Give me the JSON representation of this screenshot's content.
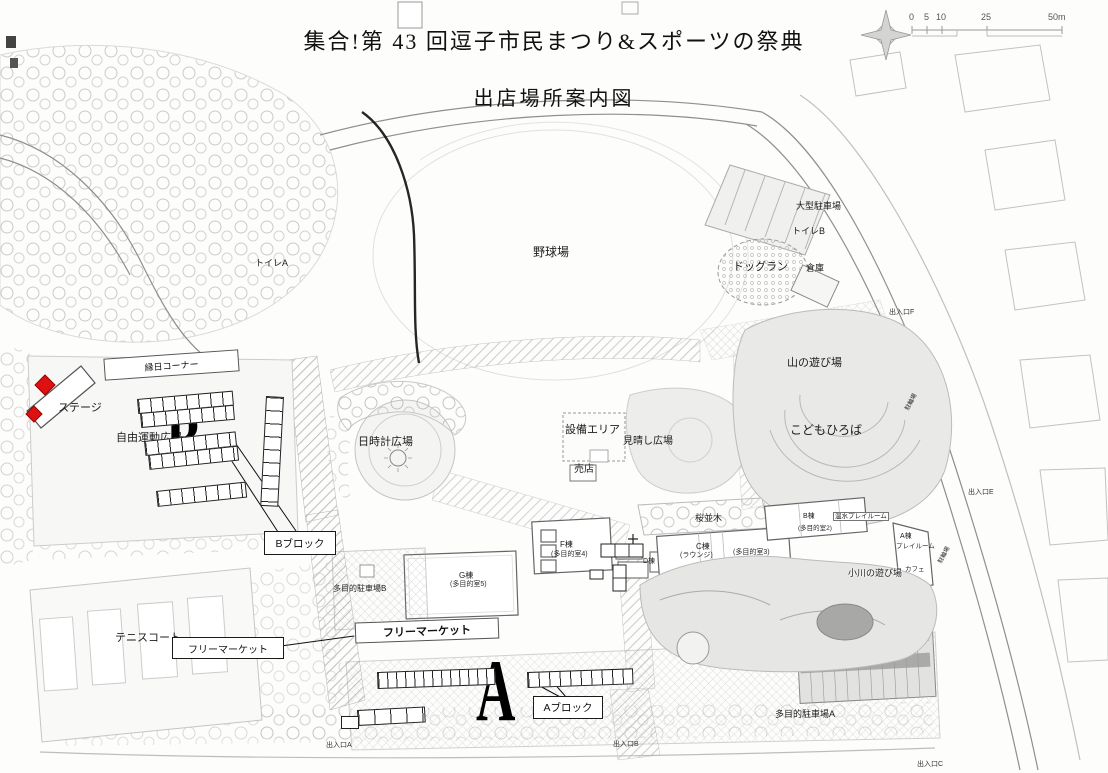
{
  "title": {
    "line1": "集合!第 43 回逗子市民まつり&スポーツの祭典",
    "line2": "出店場所案内図"
  },
  "scale": {
    "ticks": [
      "0",
      "5",
      "10",
      "25",
      "50m"
    ]
  },
  "colors": {
    "stage_red": "#dd1111",
    "ink": "#1a1a1a",
    "scan_gray": "#9a9a9a"
  },
  "annotations": {
    "ennichi_corner": "縁日コーナー",
    "stage": "ステージ",
    "b_letter": "B",
    "b_block": "Bブロック",
    "flea_market_callout": "フリーマーケット",
    "flea_market_banner": "フリーマーケット",
    "a_letter": "A",
    "a_block": "Aブロック"
  },
  "map_labels": {
    "baseball_field": "野球場",
    "toilet_a": "トイレA",
    "large_parking": "大型駐車場",
    "toilet_b": "トイレB",
    "dog_run": "ドッグラン",
    "warehouse": "倉庫",
    "mountain_play": "山の遊び場",
    "kids_plaza": "こどもひろば",
    "sundial_plaza": "日時計広場",
    "equipment_area": "設備エリア",
    "lookout_plaza": "見晴し広場",
    "shop": "売店",
    "free_exercise_plaza": "自由運動広場",
    "tennis_court": "テニスコート",
    "bldg_g": "G棟",
    "bldg_g_sub": "(多目的室5)",
    "bldg_f": "F棟",
    "bldg_f_sub": "(多目的室4)",
    "bldg_d": "D棟",
    "bldg_c": "C棟",
    "bldg_c_lounge": "(ラウンジ)",
    "bldg_c_sub": "(多目的室3)",
    "bldg_b": "B棟",
    "bldg_b_sub": "(多目的室2)",
    "warm_playroom": "温水プレイルーム",
    "bldg_a": "A棟",
    "bldg_a_sub": "プレイルーム",
    "cafe": "カフェ",
    "cherry_row": "桜並木",
    "stream_play": "小川の遊び場",
    "parking_b": "多目的駐車場B",
    "parking_a": "多目的駐車場A",
    "bicycle_1": "駐輪場",
    "bicycle_2": "駐輪場",
    "entrance_a": "出入口A",
    "entrance_b": "出入口B",
    "entrance_c": "出入口C",
    "entrance_e": "出入口E",
    "entrance_f": "出入口F"
  }
}
